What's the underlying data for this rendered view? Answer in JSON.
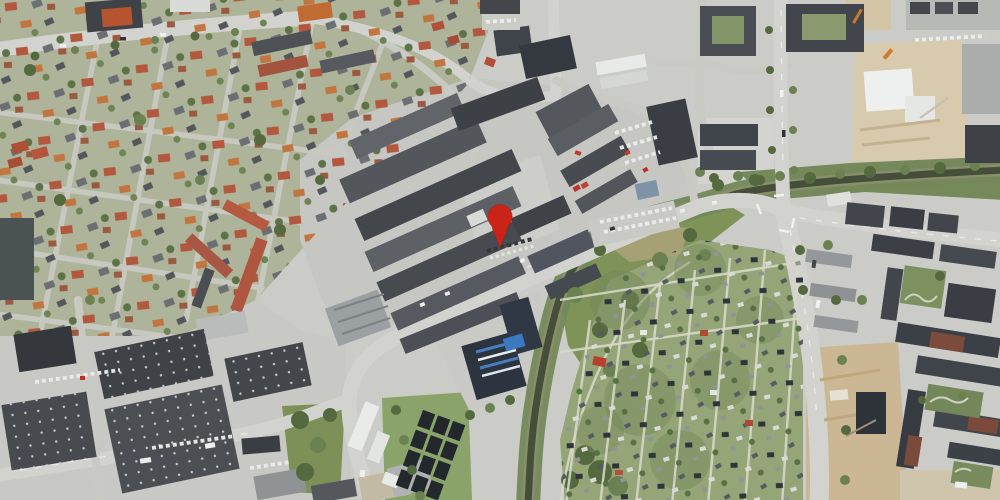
{
  "map": {
    "type": "aerial-satellite-photo",
    "size": {
      "width": 1000,
      "height": 500
    },
    "marker": {
      "name": "location-pin",
      "x": 500,
      "y": 248,
      "transform": "translate(500,248)",
      "color": "#cb2318"
    },
    "palette": {
      "ground": "#cbccc7",
      "road": "#d2d3ce",
      "road_minor": "#c9cac3",
      "water": "#454e38",
      "riparian_green": "#74885a",
      "park_green": "#7f9358",
      "allotment_green": "#95a577",
      "residential_green": "#aeb49a",
      "roof_dark": "#44484d",
      "roof_red": "#b05038",
      "construction_beige": "#d6c9ab"
    }
  }
}
